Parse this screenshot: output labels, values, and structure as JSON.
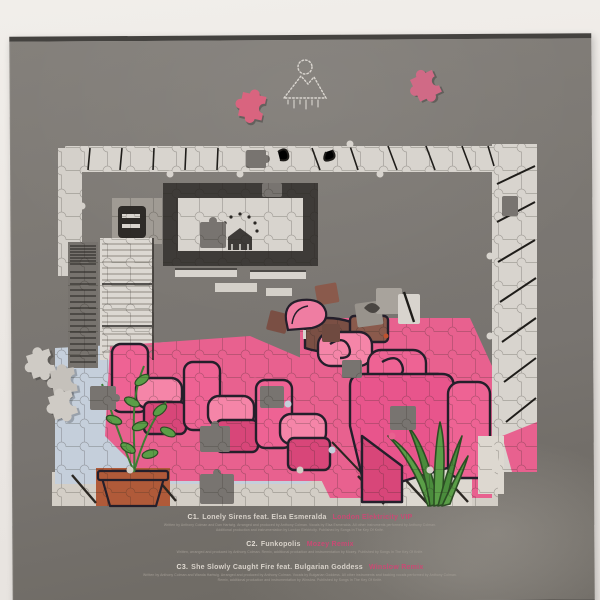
{
  "photo": {
    "backdrop_color": "#ece8e4",
    "sleeve_color": "#787470",
    "sleeve_edge_color": "#44423f",
    "accent_pink": "#c94a74",
    "subject": "Back cover of a grey vinyl record sleeve showing a partially assembled jigsaw puzzle artwork with scattered loose pieces, a dotted mountain logo and a three-track listing"
  },
  "logo": {
    "icon": "mountain-sun-logo"
  },
  "puzzle": {
    "subject": "Partially assembled jigsaw of a pink living-room illustration",
    "elements": [
      "wall border of white pieces with black panel lines",
      "fireplace with dotted arch and andiron",
      "speaker cabinet",
      "dark radiator",
      "white window blinds",
      "row of three pink armchairs",
      "pink sofa group with rolled arms",
      "houseplant in terracotta pot",
      "agave plant",
      "pale blue tiled floor",
      "brown fragments",
      "floating pink boot-shaped cluster",
      "floating grey cluster"
    ],
    "colors": {
      "border_white": "#d8d4ce",
      "line_black": "#1f1d1a",
      "pink": "#e8618f",
      "pink_light": "#f585a8",
      "pink_dark": "#d84679",
      "floor_blue": "#c5cfdb",
      "green": "#5a9e47",
      "brown": "#7a4f44",
      "terracotta": "#b05a39",
      "radiator_grey": "#77736e"
    },
    "loose_pieces": [
      {
        "color": "pink",
        "position": "upper-left of sleeve"
      },
      {
        "color": "pink",
        "position": "upper-right of sleeve"
      },
      {
        "color": "grey",
        "position": "cluster of three near left edge"
      }
    ]
  },
  "tracklist": {
    "tracks": [
      {
        "position": "C1.",
        "title": "Lonely Sirens feat. Elsa Esmeralda",
        "remix": "London Elektricity VIP",
        "credits_line1": "Written by Anthony Colman and Dan Hartwig. Arranged and produced by Anthony Colman. Vocals by Elsa Esmeralda. All other instruments performed by Anthony Colman.",
        "credits_line2": "Additional production and instrumentation by London Elektricity. Published by Songs In The Key Of Knife."
      },
      {
        "position": "C2.",
        "title": "Funkopolis",
        "remix": "Mozey Remix",
        "credits_line1": "Written, arranged and produced by Anthony Colman. Remix, additional production and instrumentation by Mozey. Published by Songs In The Key Of Knife.",
        "credits_line2": ""
      },
      {
        "position": "C3.",
        "title": "She Slowly Caught Fire feat. Bulgarian Goddess",
        "remix": "Winslow Remix",
        "credits_line1": "Written by Anthony Colman and Wanda Hartwig. Arranged and produced by Anthony Colman. Vocals by Bulgarian Goddess. All other instruments and backing vocals performed by Anthony Colman.",
        "credits_line2": "Remix, additional production and instrumentation by Winslow. Published by Songs In The Key Of Knife."
      }
    ]
  }
}
